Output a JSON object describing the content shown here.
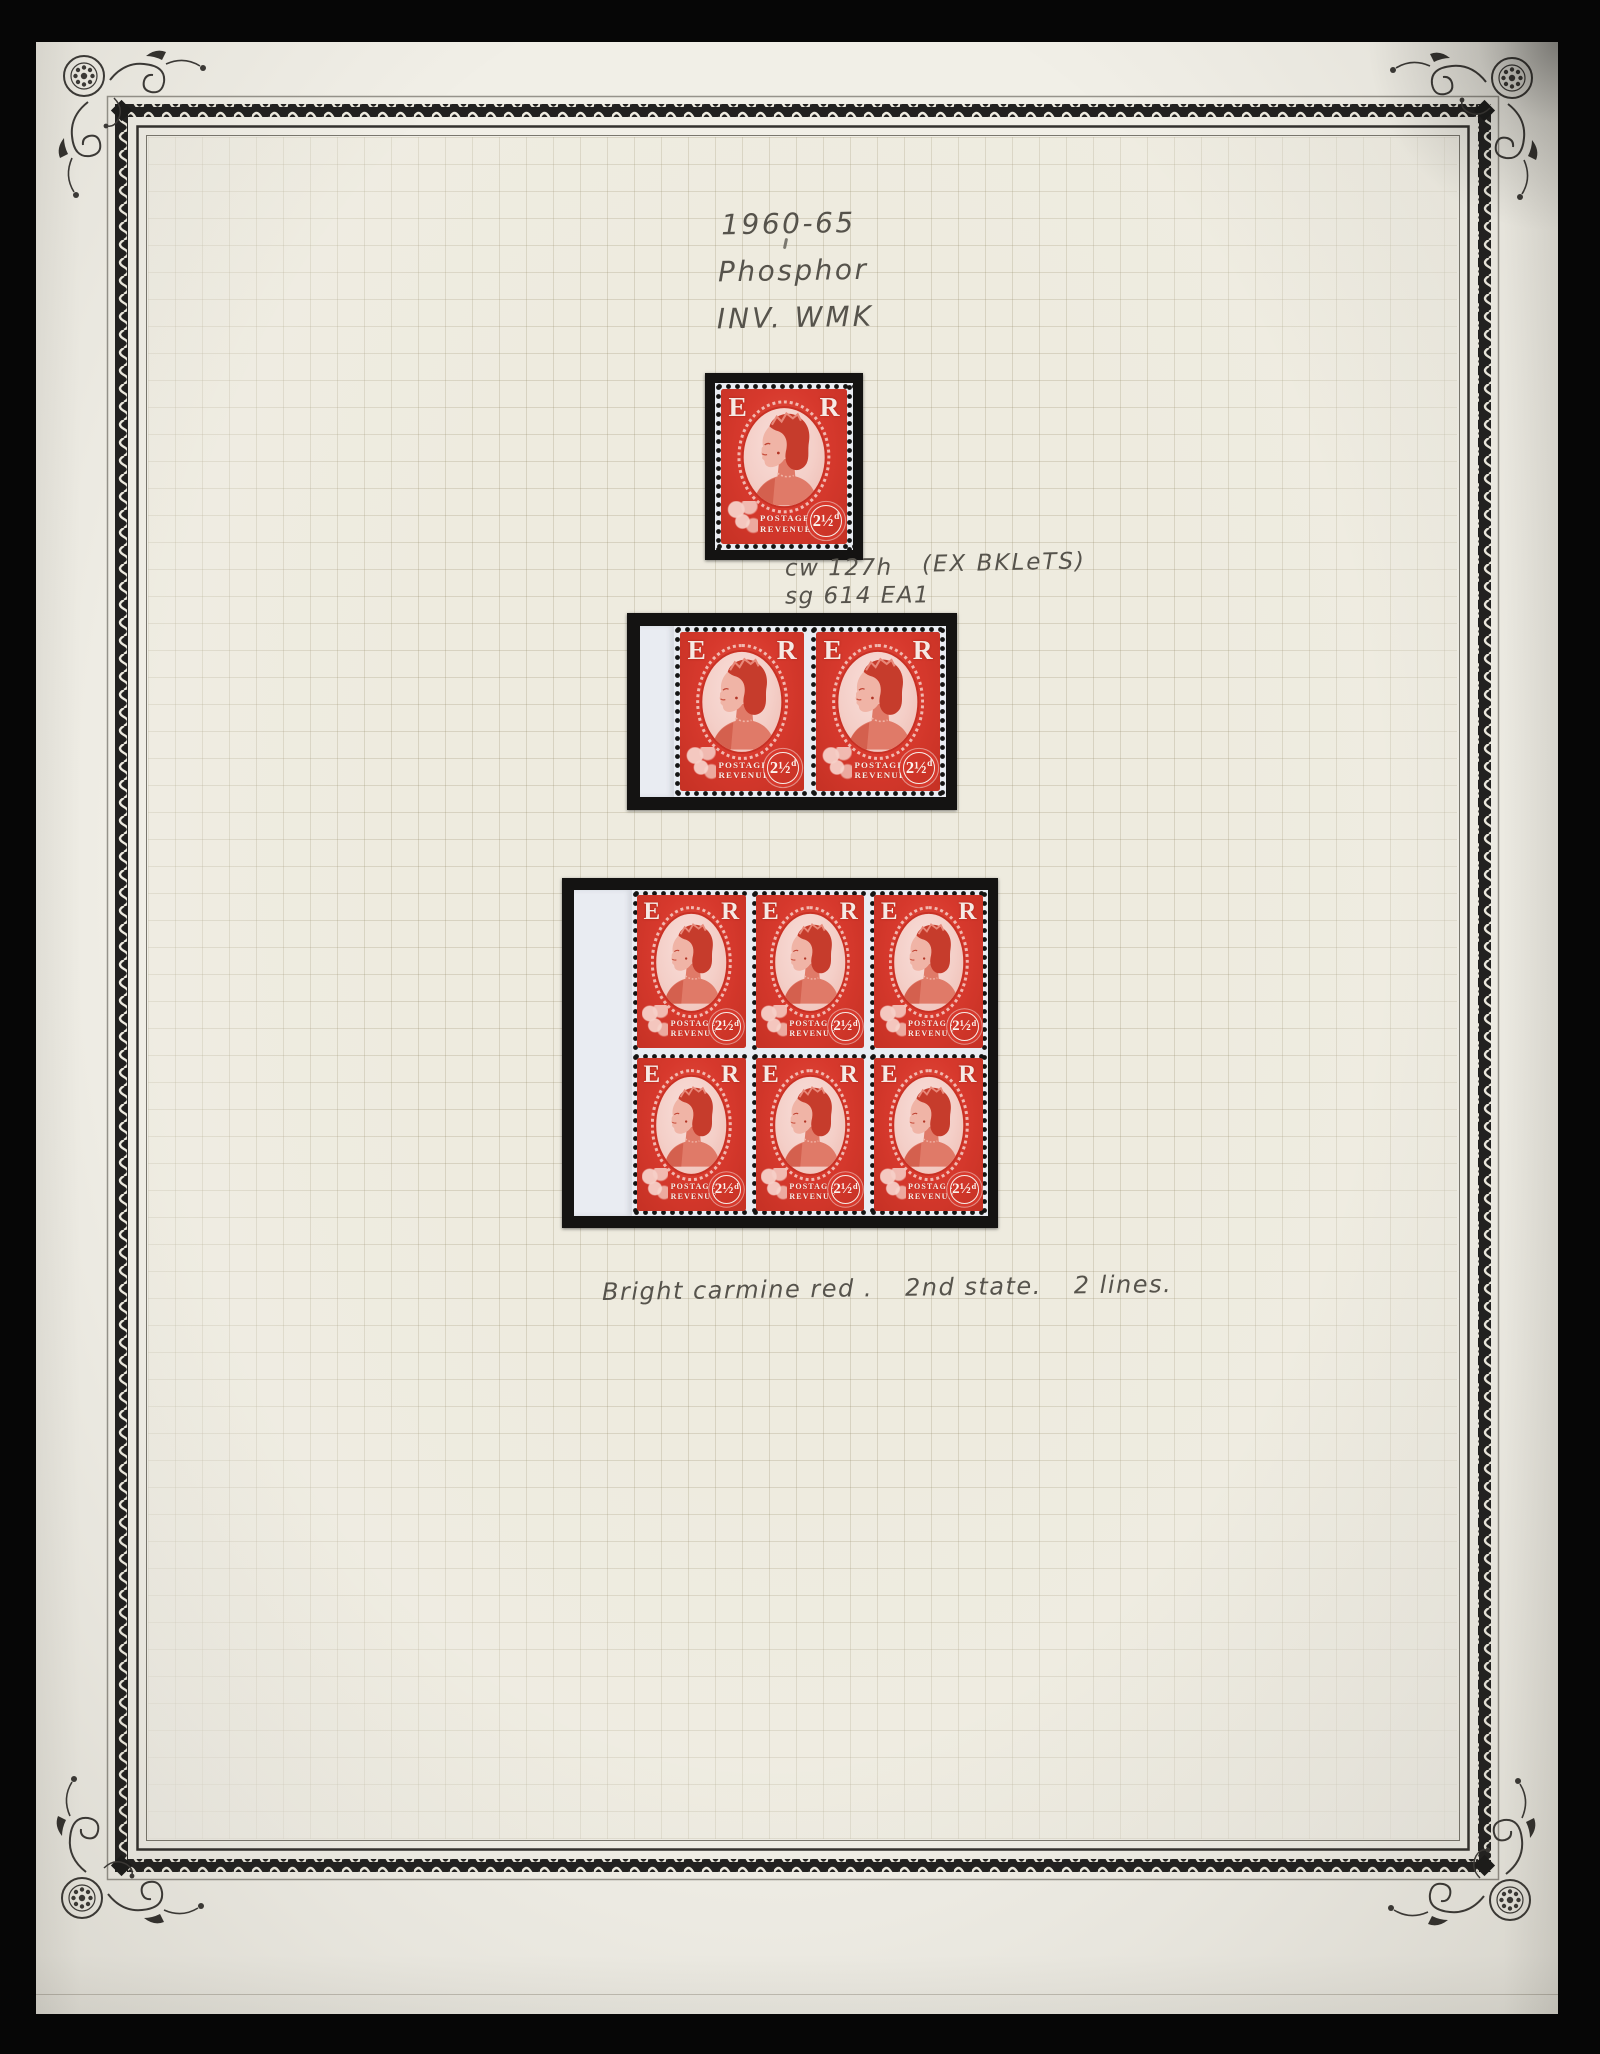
{
  "handwriting": {
    "heading": [
      "1960-65",
      "Phosphor",
      "INV. WMK"
    ],
    "catalog": [
      "cw 127h",
      "sg 614 EA1"
    ],
    "catalog_note": "(EX BKLeTS)",
    "bottom_note_parts": [
      "Bright carmine red .",
      "2nd state.",
      "2 lines."
    ]
  },
  "stamp": {
    "top_left_letter": "E",
    "top_right_letter": "R",
    "bottom_text_line1": "POSTAGE",
    "bottom_text_line2": "REVENUE",
    "value": "2½",
    "value_suffix": "d"
  },
  "mounts": [
    {
      "name": "single-stamp",
      "rows": 1,
      "cols": 1,
      "selvedge": false
    },
    {
      "name": "booklet-pair-with-selvedge",
      "rows": 1,
      "cols": 2,
      "selvedge": true
    },
    {
      "name": "booklet-block-of-six-with-selvedge",
      "rows": 2,
      "cols": 3,
      "selvedge": true
    }
  ],
  "colors": {
    "stamp_red": "#d7392d",
    "stamp_red_dark": "#c53124",
    "oval_pink": "#f4cfc8",
    "page_cream": "#f1efe7",
    "grid_cream": "#eeebdf",
    "mount_black": "#141312",
    "stamp_paper": "#e9ecf2",
    "pencil_gray": "#56534c",
    "border_ink": "#2e2c29"
  }
}
